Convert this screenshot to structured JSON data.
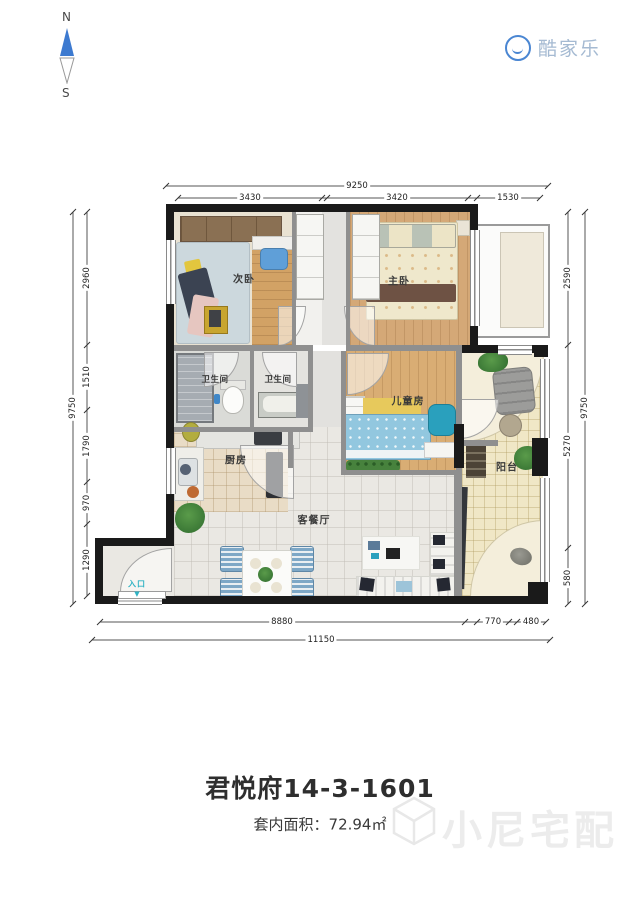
{
  "compass": {
    "north_label": "N",
    "south_label": "S"
  },
  "brand": {
    "name": "酷家乐"
  },
  "rooms": {
    "secondary_bedroom": "次卧",
    "master_bedroom": "主卧",
    "bathroom_left": "卫生间",
    "bathroom_right": "卫生间",
    "children_room": "儿童房",
    "kitchen": "厨房",
    "living_dining": "客餐厅",
    "balcony": "阳台",
    "entrance": "入口",
    "entrance_arrow": "▼"
  },
  "dimensions": {
    "top": {
      "total": "9250",
      "segments": [
        "3430",
        "3420",
        "1530"
      ]
    },
    "left": {
      "total": "9750",
      "segments": [
        "2960",
        "1510",
        "1790",
        "970",
        "1290"
      ]
    },
    "right": {
      "total": "9750",
      "segments": [
        "2590",
        "5270",
        "580"
      ]
    },
    "bottom": {
      "total": "11150",
      "segments": [
        "8880",
        "770",
        "480"
      ]
    }
  },
  "footer": {
    "title": "君悦府14-3-1601",
    "area_label": "套内面积：",
    "area_value": "72.94㎡"
  },
  "watermark": {
    "text": "小尼宅配"
  },
  "colors": {
    "brand_blue": "#4a86d2",
    "brand_text": "#a5bad2",
    "wall_black": "#1a1a1a",
    "partition_gray": "#8f8f8f",
    "entry_teal": "#2fb3c4",
    "wood": "#d4a877"
  }
}
